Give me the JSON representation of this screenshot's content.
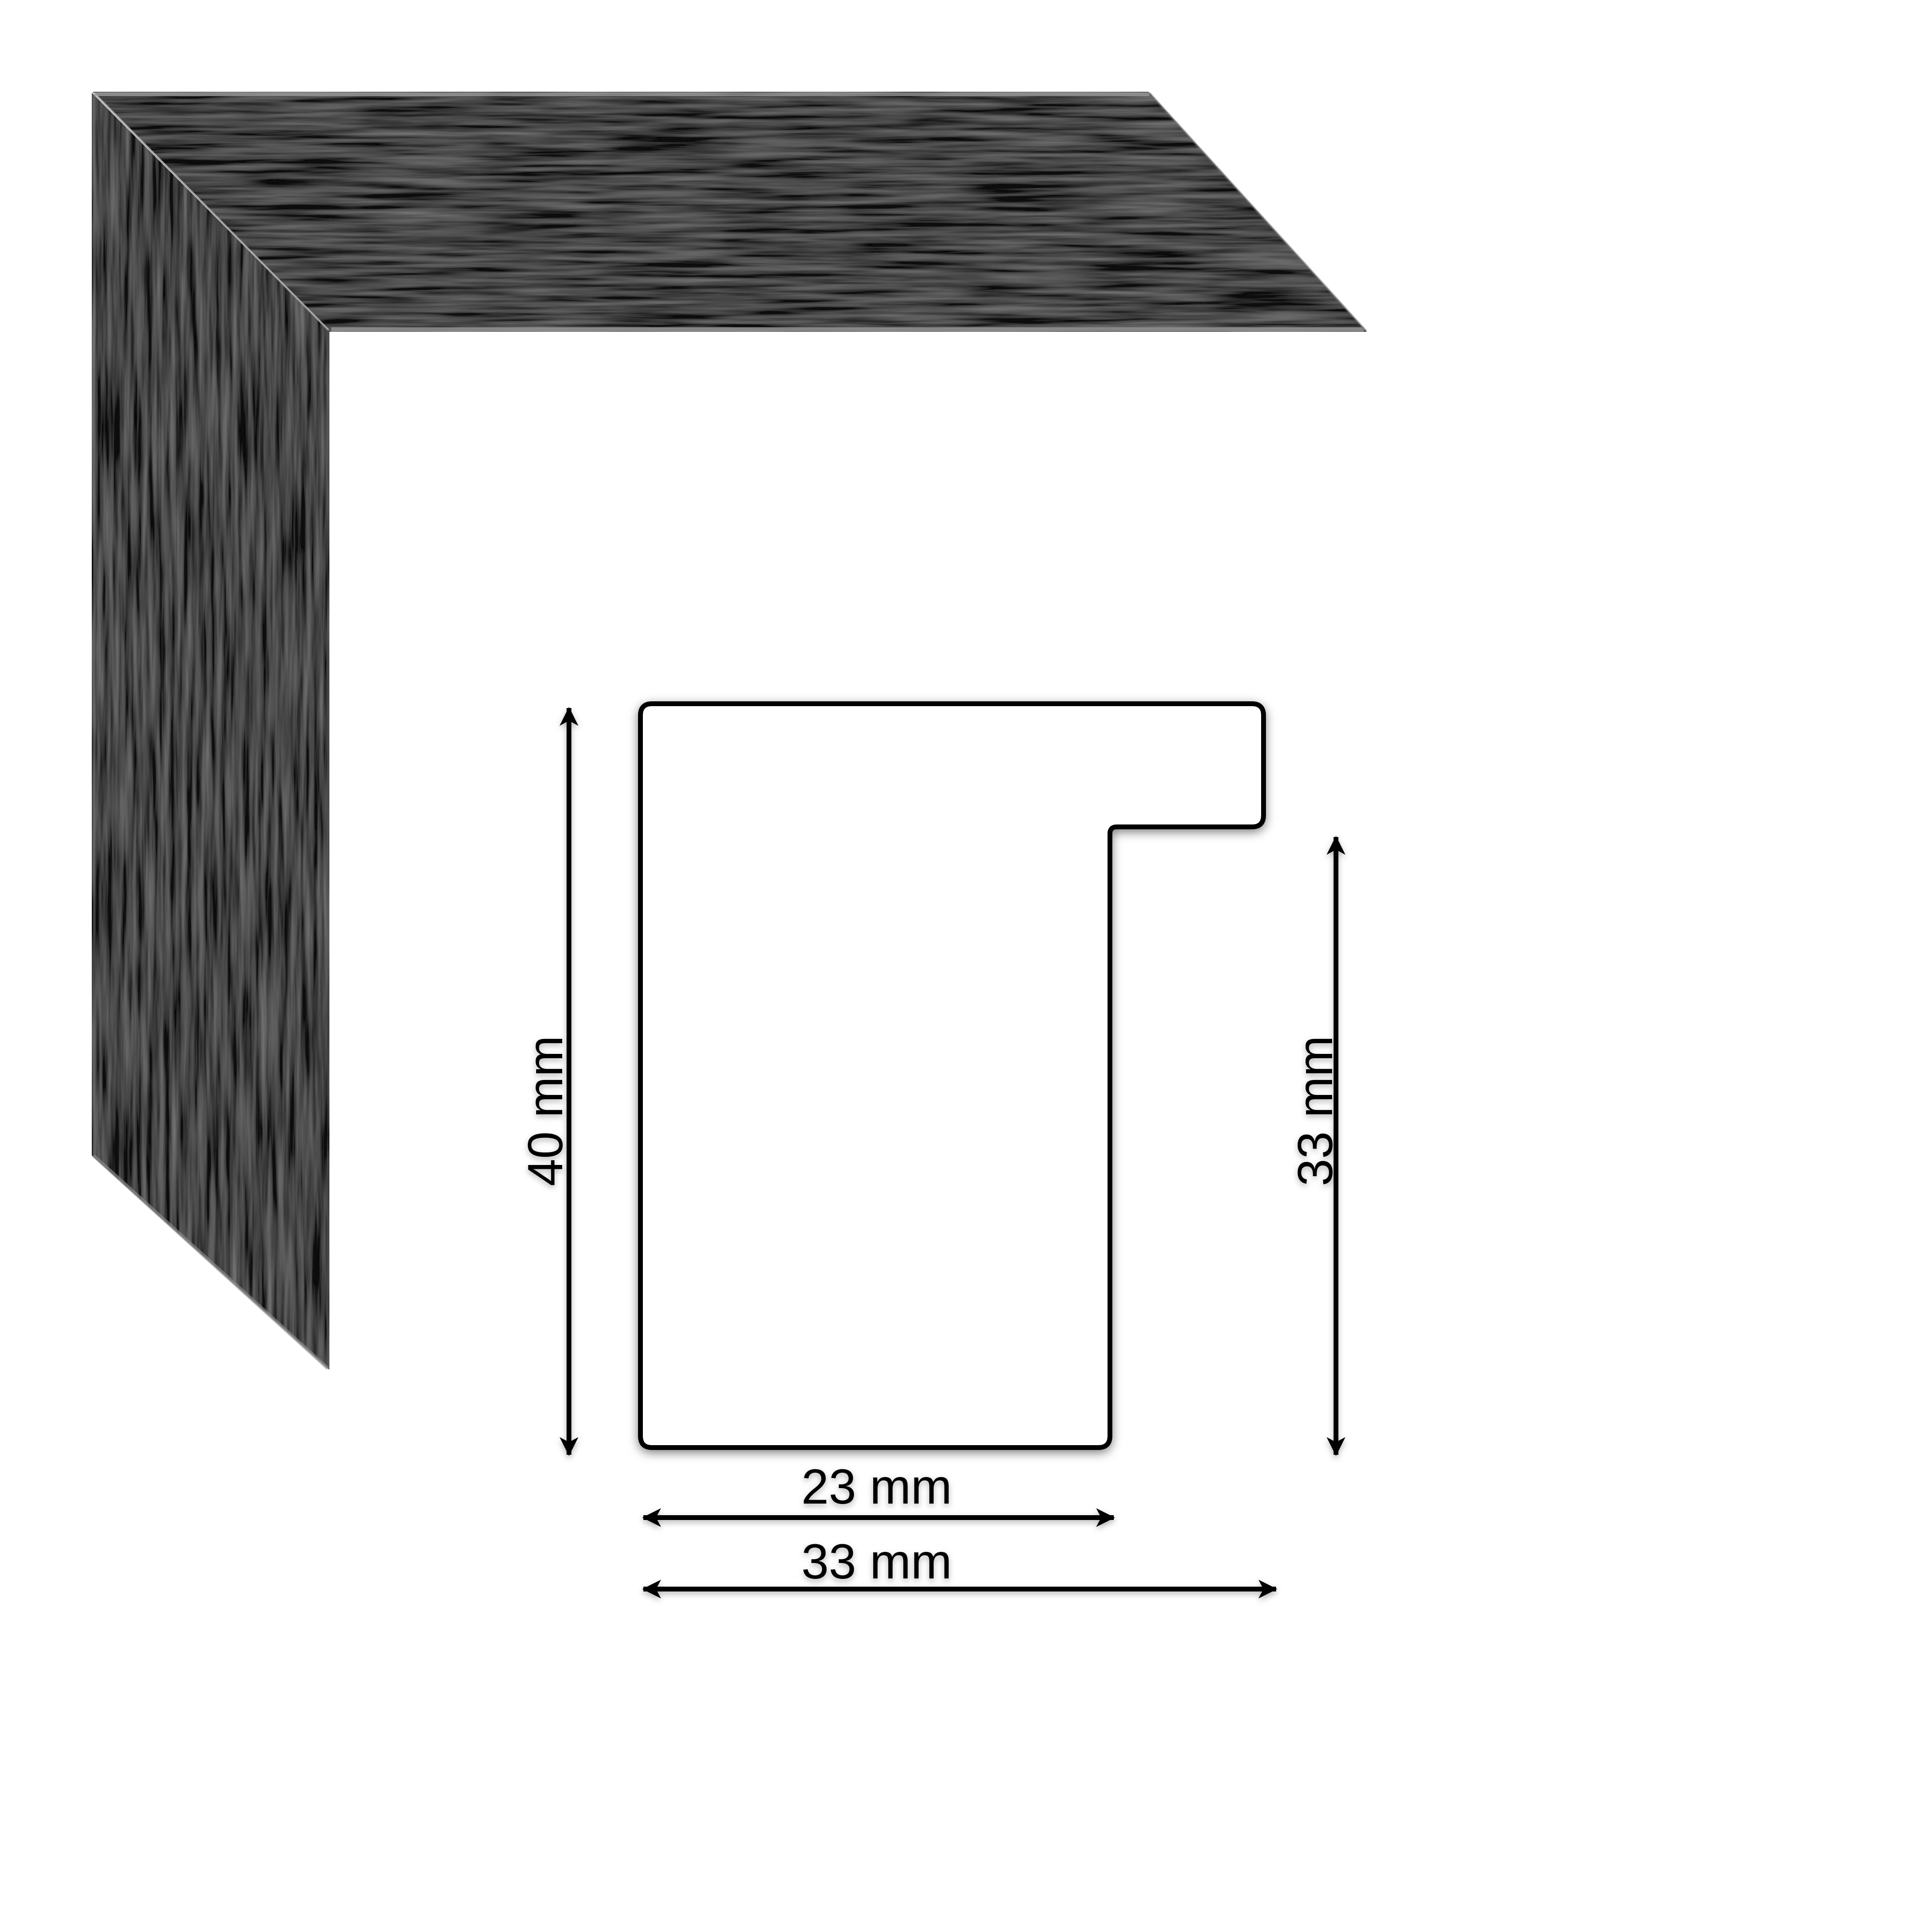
{
  "colors": {
    "background": "#ffffff",
    "frame_black": "#101010",
    "grain_streak": "#2b2b2b",
    "edge_highlight": "#9f9f9f",
    "miter_seam": "#b0b0b0",
    "outline": "#000000",
    "text": "#000000"
  },
  "frame_photo": {
    "subject": "black wood-grain picture frame corner sample"
  },
  "diagram": {
    "unit": "mm",
    "labels": {
      "total_height": "40 mm",
      "rabbet_height": "33 mm",
      "face_width": "23 mm",
      "total_width": "33 mm"
    },
    "values": {
      "total_height_mm": 40,
      "rabbet_height_mm": 33,
      "face_width_mm": 23,
      "total_width_mm": 33
    }
  }
}
